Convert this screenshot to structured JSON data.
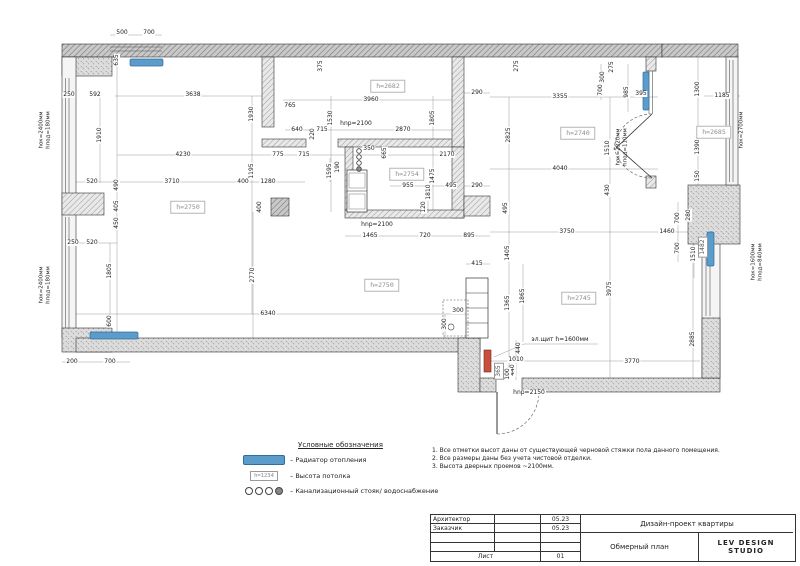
{
  "accent_colors": {
    "radiator_blue": "#5b9ccb",
    "panel_red": "#c94f3d",
    "wall_gray": "#d9d9d9"
  },
  "legend": {
    "title": "Условные обозначения",
    "items": [
      {
        "symbol": "radiator-symbol",
        "label": "– Радиатор отопления"
      },
      {
        "symbol": "height-box-symbol",
        "sample": "h=1234",
        "label": "– Высота потолка"
      },
      {
        "symbol": "sewer-stack-symbol",
        "label": "– Канализационный стояк/ водоснабжение"
      }
    ]
  },
  "notes": [
    "1.  Все отметки высот даны от существующей черновой стяжки пола данного помещения.",
    "2.  Все размеры даны без учета чистовой отделки.",
    "3.  Высота дверных проемов ~2100мм."
  ],
  "titleblock": {
    "architect_label": "Архитектор",
    "client_label": "Заказчик",
    "date1": "05.23",
    "date2": "05.23",
    "project": "Дизайн-проект квартиры",
    "drawing": "Обмерный план",
    "studio": "LEV DESIGN STUDIO",
    "sheet_label": "Лист",
    "sheet_number": "01"
  },
  "plan": {
    "room_heights": [
      {
        "t": "h=2682",
        "x": 388,
        "y": 86
      },
      {
        "t": "h=2754",
        "x": 407,
        "y": 174
      },
      {
        "t": "h=2740",
        "x": 578,
        "y": 133
      },
      {
        "t": "h=2750",
        "x": 188,
        "y": 207
      },
      {
        "t": "h=2750",
        "x": 382,
        "y": 285
      },
      {
        "t": "h=2745",
        "x": 579,
        "y": 298
      },
      {
        "t": "h=2685",
        "x": 714,
        "y": 132
      }
    ],
    "window_annotations": [
      {
        "t": "hок=2400мм\nhпод=180мм",
        "x": 45,
        "y": 130
      },
      {
        "t": "hок=2400мм\nhпод=180мм",
        "x": 45,
        "y": 285
      },
      {
        "t": "hок=2320мм\nhпод=110мм",
        "x": 622,
        "y": 147
      },
      {
        "t": "hок=2700мм",
        "x": 742,
        "y": 130
      },
      {
        "t": "hок=1600мм\nhпод=840мм",
        "x": 757,
        "y": 262
      }
    ],
    "dimensions": [
      {
        "t": "500",
        "x": 122,
        "y": 33
      },
      {
        "t": "700",
        "x": 149,
        "y": 33
      },
      {
        "t": "250",
        "x": 69,
        "y": 95
      },
      {
        "t": "592",
        "x": 95,
        "y": 95
      },
      {
        "t": "3638",
        "x": 193,
        "y": 95
      },
      {
        "t": "3960",
        "x": 371,
        "y": 100
      },
      {
        "t": "290",
        "x": 477,
        "y": 93
      },
      {
        "t": "765",
        "x": 290,
        "y": 106
      },
      {
        "t": "3355",
        "x": 560,
        "y": 97
      },
      {
        "t": "395",
        "x": 641,
        "y": 94
      },
      {
        "t": "1185",
        "x": 722,
        "y": 96
      },
      {
        "t": "640",
        "x": 297,
        "y": 130
      },
      {
        "t": "715",
        "x": 322,
        "y": 130
      },
      {
        "t": "2870",
        "x": 403,
        "y": 130
      },
      {
        "t": "4230",
        "x": 183,
        "y": 155
      },
      {
        "t": "775",
        "x": 278,
        "y": 155
      },
      {
        "t": "715",
        "x": 304,
        "y": 155
      },
      {
        "t": "350",
        "x": 369,
        "y": 149
      },
      {
        "t": "2170",
        "x": 447,
        "y": 155
      },
      {
        "t": "4040",
        "x": 560,
        "y": 169
      },
      {
        "t": "520",
        "x": 92,
        "y": 182
      },
      {
        "t": "3710",
        "x": 172,
        "y": 182
      },
      {
        "t": "400",
        "x": 243,
        "y": 182
      },
      {
        "t": "1280",
        "x": 268,
        "y": 182
      },
      {
        "t": "955",
        "x": 408,
        "y": 186
      },
      {
        "t": "495",
        "x": 451,
        "y": 186
      },
      {
        "t": "290",
        "x": 477,
        "y": 186
      },
      {
        "t": "250",
        "x": 73,
        "y": 243
      },
      {
        "t": "520",
        "x": 92,
        "y": 243
      },
      {
        "t": "1465",
        "x": 370,
        "y": 236
      },
      {
        "t": "720",
        "x": 425,
        "y": 236
      },
      {
        "t": "895",
        "x": 469,
        "y": 236
      },
      {
        "t": "3750",
        "x": 567,
        "y": 232
      },
      {
        "t": "1460",
        "x": 667,
        "y": 232
      },
      {
        "t": "6340",
        "x": 268,
        "y": 314
      },
      {
        "t": "415",
        "x": 477,
        "y": 264
      },
      {
        "t": "300",
        "x": 458,
        "y": 311
      },
      {
        "t": "200",
        "x": 72,
        "y": 362
      },
      {
        "t": "700",
        "x": 110,
        "y": 362
      },
      {
        "t": "1010",
        "x": 516,
        "y": 360
      },
      {
        "t": "3770",
        "x": 632,
        "y": 362
      },
      {
        "t": "hnp=2100",
        "x": 356,
        "y": 124
      },
      {
        "t": "hnp=2100",
        "x": 377,
        "y": 225
      },
      {
        "t": "hnp=2150",
        "x": 529,
        "y": 393
      },
      {
        "t": "эл.щит h=1600мм",
        "x": 560,
        "y": 340
      },
      {
        "t": "635",
        "x": 117,
        "y": 60,
        "v": 1
      },
      {
        "t": "1910",
        "x": 100,
        "y": 135,
        "v": 1
      },
      {
        "t": "1930",
        "x": 252,
        "y": 114,
        "v": 1
      },
      {
        "t": "375",
        "x": 321,
        "y": 66,
        "v": 1
      },
      {
        "t": "275",
        "x": 517,
        "y": 66,
        "v": 1
      },
      {
        "t": "275",
        "x": 612,
        "y": 67,
        "v": 1
      },
      {
        "t": "1530",
        "x": 331,
        "y": 118,
        "v": 1
      },
      {
        "t": "1805",
        "x": 433,
        "y": 118,
        "v": 1
      },
      {
        "t": "220",
        "x": 313,
        "y": 134,
        "v": 1
      },
      {
        "t": "190",
        "x": 338,
        "y": 167,
        "v": 1
      },
      {
        "t": "665",
        "x": 385,
        "y": 153,
        "v": 1
      },
      {
        "t": "1595",
        "x": 330,
        "y": 171,
        "v": 1
      },
      {
        "t": "1475",
        "x": 433,
        "y": 176,
        "v": 1
      },
      {
        "t": "1810",
        "x": 429,
        "y": 192,
        "v": 1
      },
      {
        "t": "120",
        "x": 424,
        "y": 207,
        "v": 1
      },
      {
        "t": "300",
        "x": 603,
        "y": 77,
        "v": 1
      },
      {
        "t": "700",
        "x": 601,
        "y": 90,
        "v": 1
      },
      {
        "t": "985",
        "x": 627,
        "y": 92,
        "v": 1
      },
      {
        "t": "2825",
        "x": 509,
        "y": 135,
        "v": 1
      },
      {
        "t": "1510",
        "x": 608,
        "y": 148,
        "v": 1
      },
      {
        "t": "430",
        "x": 608,
        "y": 190,
        "v": 1
      },
      {
        "t": "1300",
        "x": 698,
        "y": 89,
        "v": 1
      },
      {
        "t": "1390",
        "x": 698,
        "y": 147,
        "v": 1
      },
      {
        "t": "150",
        "x": 698,
        "y": 176,
        "v": 1
      },
      {
        "t": "490",
        "x": 117,
        "y": 185,
        "v": 1
      },
      {
        "t": "405",
        "x": 117,
        "y": 206,
        "v": 1
      },
      {
        "t": "450",
        "x": 117,
        "y": 223,
        "v": 1
      },
      {
        "t": "1805",
        "x": 110,
        "y": 271,
        "v": 1
      },
      {
        "t": "600",
        "x": 110,
        "y": 321,
        "v": 1
      },
      {
        "t": "1195",
        "x": 252,
        "y": 171,
        "v": 1
      },
      {
        "t": "400",
        "x": 260,
        "y": 207,
        "v": 1
      },
      {
        "t": "2770",
        "x": 253,
        "y": 275,
        "v": 1
      },
      {
        "t": "1405",
        "x": 508,
        "y": 253,
        "v": 1
      },
      {
        "t": "1365",
        "x": 508,
        "y": 303,
        "v": 1
      },
      {
        "t": "1865",
        "x": 523,
        "y": 296,
        "v": 1
      },
      {
        "t": "3975",
        "x": 610,
        "y": 289,
        "v": 1
      },
      {
        "t": "2885",
        "x": 693,
        "y": 339,
        "v": 1
      },
      {
        "t": "700",
        "x": 678,
        "y": 218,
        "v": 1
      },
      {
        "t": "280",
        "x": 689,
        "y": 215,
        "v": 1
      },
      {
        "t": "700",
        "x": 678,
        "y": 248,
        "v": 1
      },
      {
        "t": "1510",
        "x": 694,
        "y": 254,
        "v": 1
      },
      {
        "t": "495",
        "x": 506,
        "y": 208,
        "v": 1
      },
      {
        "t": "440",
        "x": 519,
        "y": 348,
        "v": 1
      },
      {
        "t": "440",
        "x": 513,
        "y": 370,
        "v": 1
      },
      {
        "t": "100",
        "x": 508,
        "y": 374,
        "v": 1
      },
      {
        "t": "300",
        "x": 445,
        "y": 324,
        "v": 1
      },
      {
        "t": "365",
        "x": 499,
        "y": 371,
        "v": 1,
        "box": 1
      },
      {
        "t": "1482",
        "x": 703,
        "y": 247,
        "v": 1,
        "box": 1
      }
    ]
  }
}
